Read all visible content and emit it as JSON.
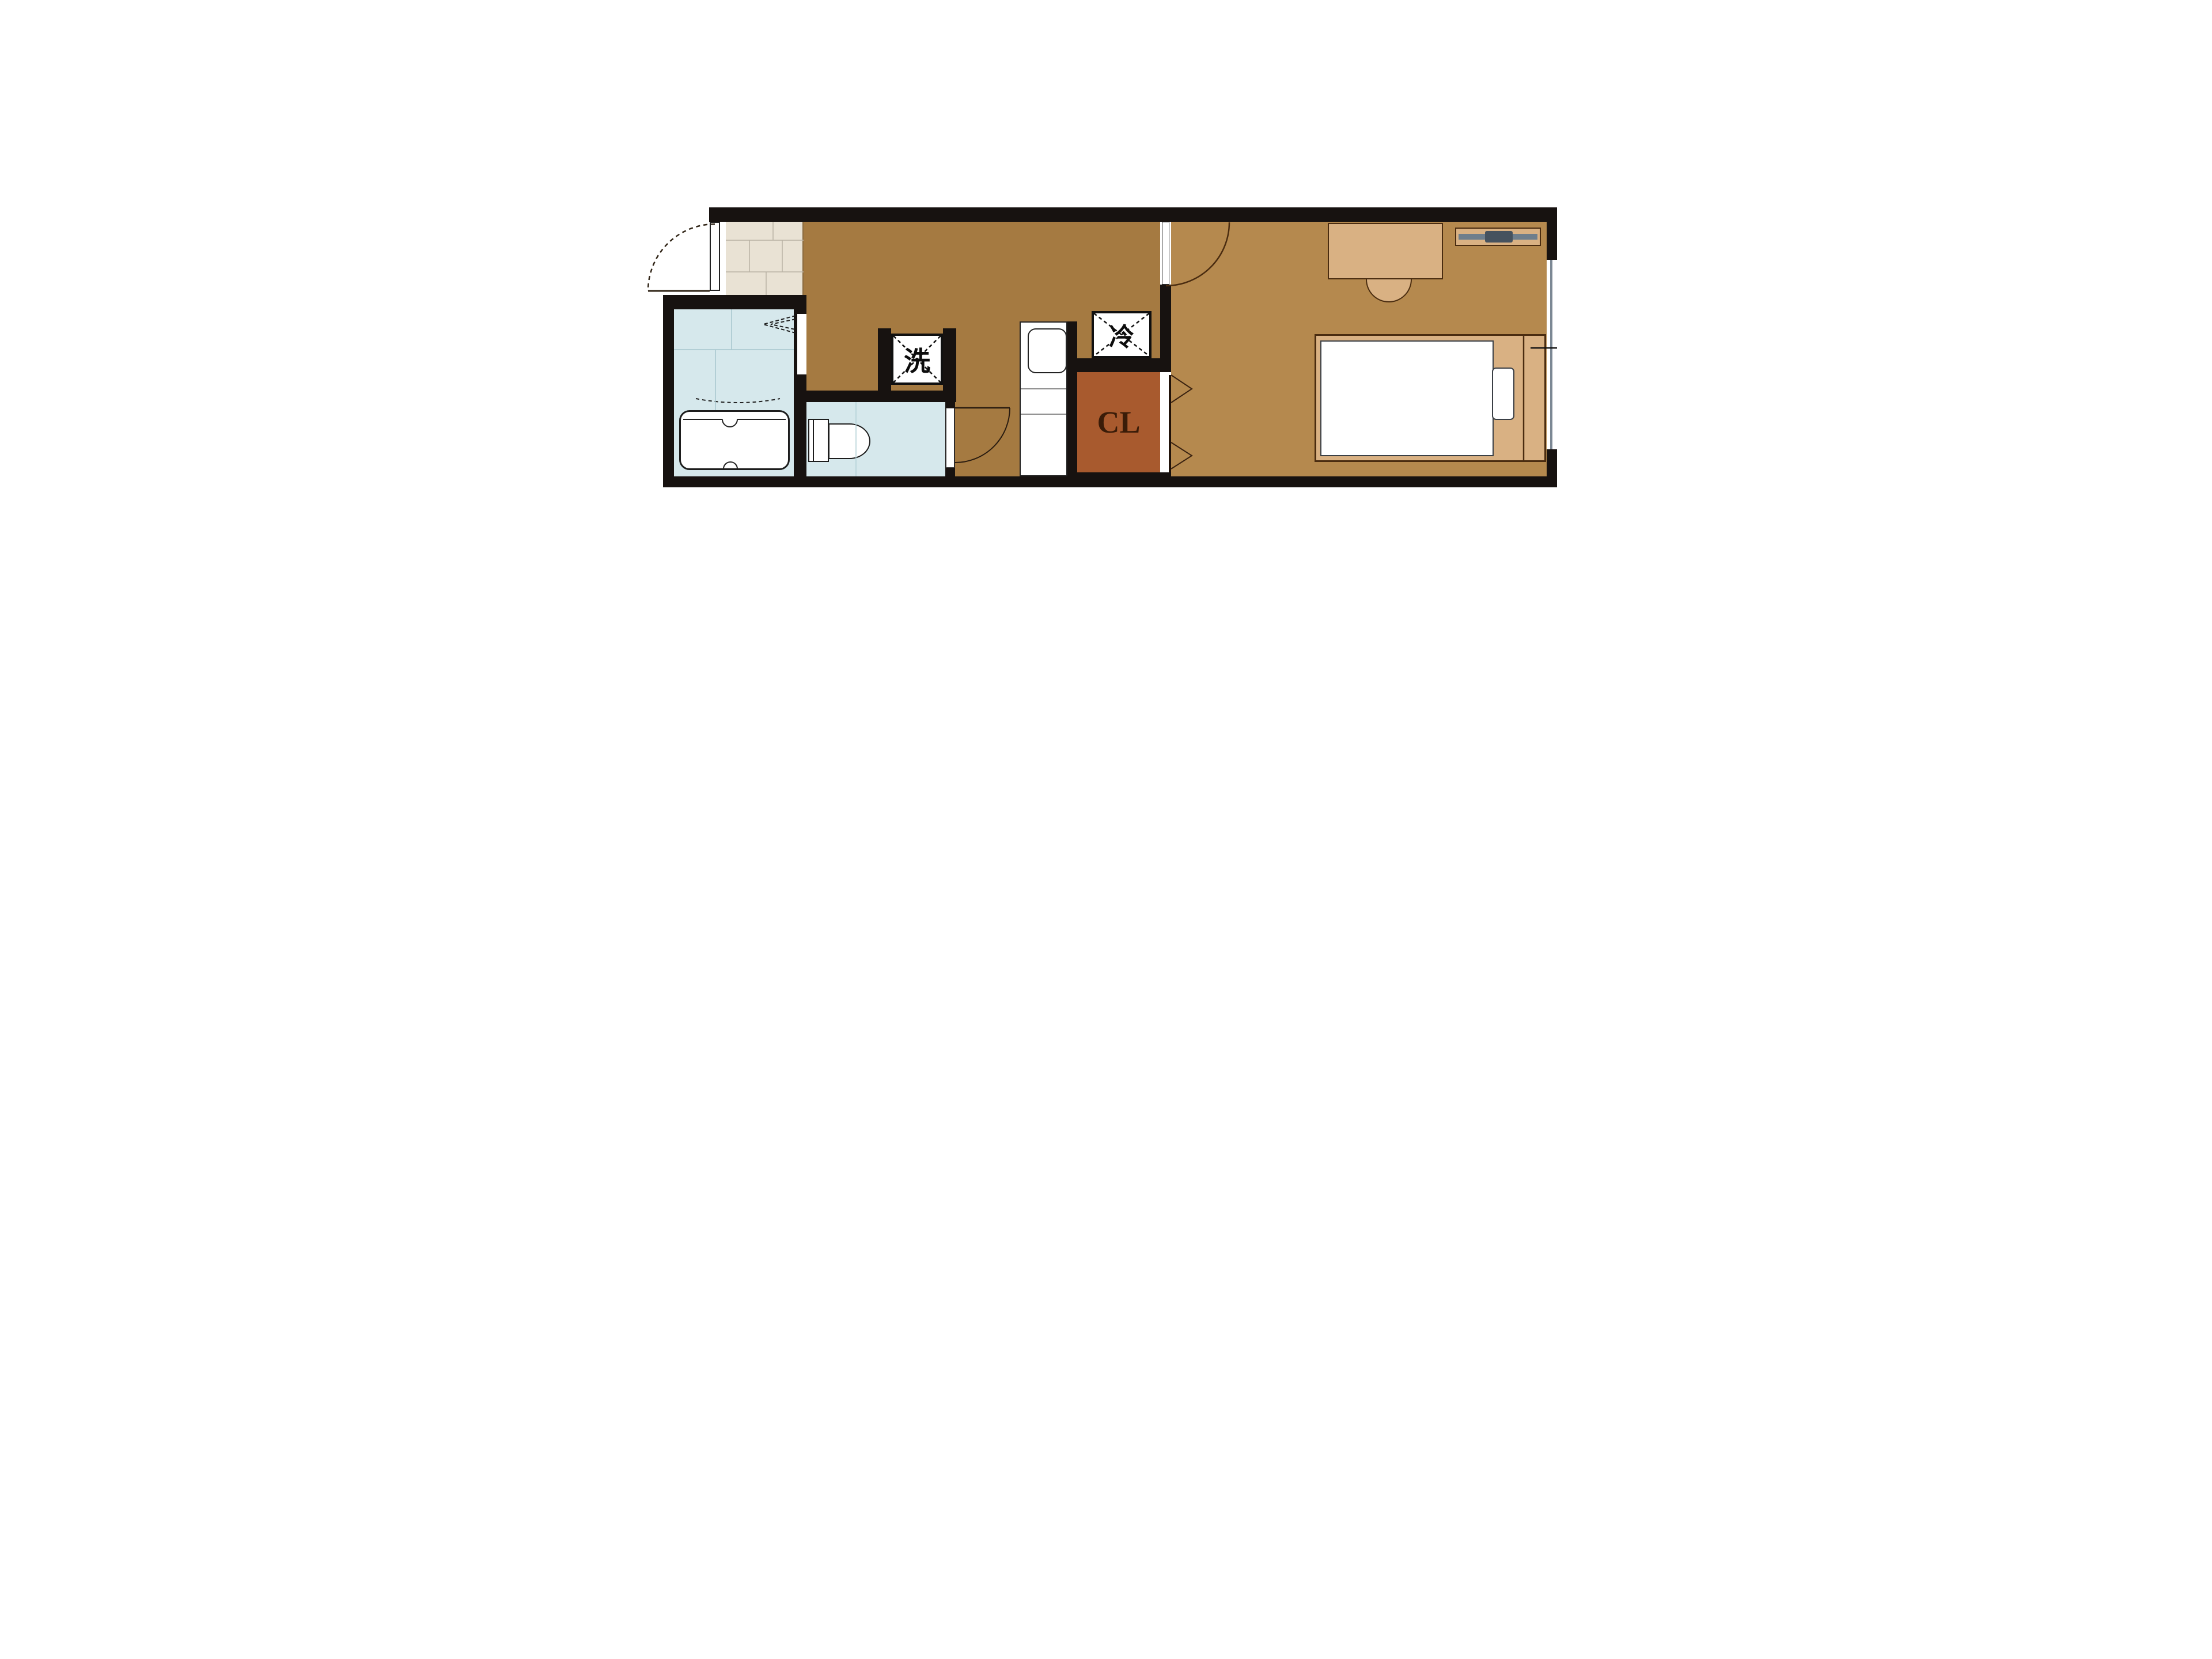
{
  "floorplan": {
    "labels": {
      "washer": "洗",
      "refrigerator": "冷",
      "closet": "CL"
    },
    "colors": {
      "wall": "#171210",
      "kitchen_floor": "#A57A41",
      "bedroom_floor": "#B5894E",
      "entry_tile_floor": "#E9E2D4",
      "wet_room_floor": "#D6E8EC",
      "closet_fill": "#A85A2E",
      "furniture_wood": "#D9B183",
      "fixture_white": "#FFFFFF",
      "tv_bar": "#6E7E8C",
      "tv_screen": "#46525E",
      "window_glass": "#7C8894"
    },
    "fixtures": [
      "entrance-door",
      "door-swing-arc",
      "entry-tile",
      "bathtub",
      "bathroom",
      "folding-door",
      "toilet",
      "toilet-door",
      "washing-machine-space",
      "kitchen-counter",
      "kitchen-sink",
      "refrigerator-space",
      "closet",
      "closet-folding-door",
      "bedroom-door",
      "bed",
      "mattress",
      "pillow",
      "desk",
      "desk-chair",
      "tv-board",
      "window"
    ]
  }
}
